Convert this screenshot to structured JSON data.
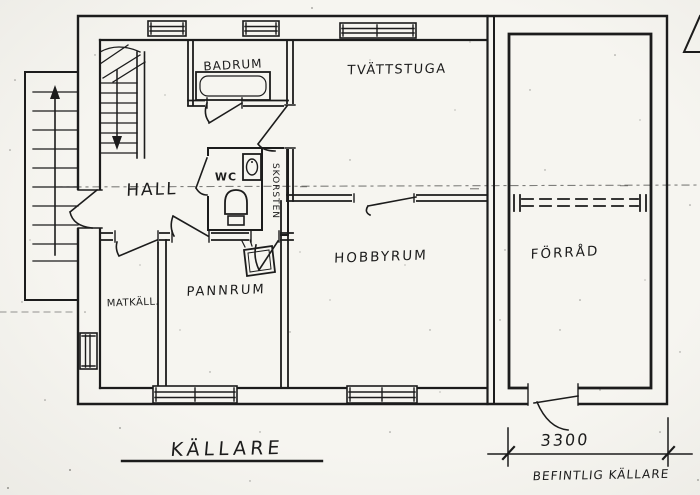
{
  "drawing": {
    "title": "KÄLLARE",
    "rooms": {
      "hall": "HALL",
      "badrum": "BADRUM",
      "tvattstuga": "TVÄTTSTUGA",
      "wc": "WC",
      "skorsten": "SKORSTEN",
      "matkall": "MATKÄLL.",
      "pannrum": "PANNRUM",
      "hobbyrum": "HOBBYRUM",
      "forrad": "FÖRRÅD"
    },
    "dimension": {
      "length": "3300",
      "caption": "BEFINTLIG KÄLLARE"
    },
    "colors": {
      "ink": "#1c1c1c",
      "paper": "#f6f5f0"
    }
  }
}
